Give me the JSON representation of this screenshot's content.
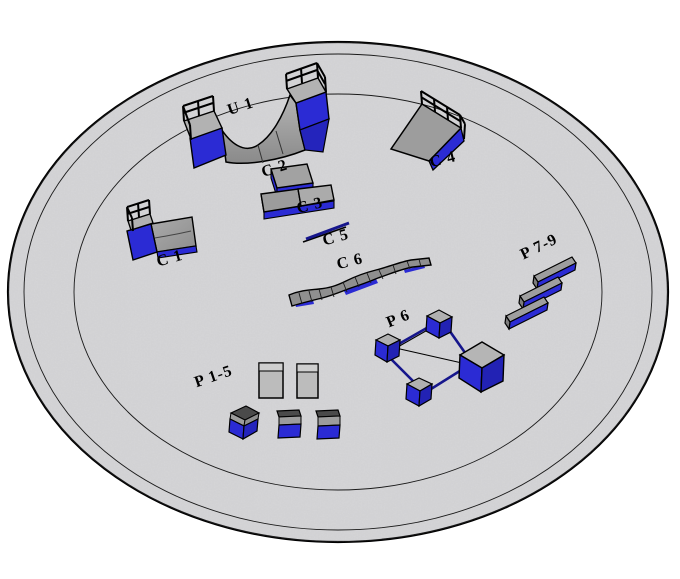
{
  "viewport": {
    "width": 680,
    "height": 579,
    "background": "#ffffff"
  },
  "pad": {
    "surface_color": "#d8d8da",
    "edge_color": "#000000",
    "ring_count": 3
  },
  "palette": {
    "obstacle_blue": "#2b2bd4",
    "obstacle_blue_dark": "#2222b4",
    "rail_navy": "#16168c",
    "ramp_gray": "#9a9a9a",
    "deck_gray": "#b5b5b5",
    "cube_top_dark": "#4a4a4a",
    "outline": "#000000"
  },
  "obstacles": [
    {
      "id": "u1",
      "label": "U 1"
    },
    {
      "id": "c1",
      "label": "C 1"
    },
    {
      "id": "c2",
      "label": "C 2"
    },
    {
      "id": "c3",
      "label": "C 3"
    },
    {
      "id": "c4",
      "label": "C 4"
    },
    {
      "id": "c5",
      "label": "C 5"
    },
    {
      "id": "c6",
      "label": "C 6"
    },
    {
      "id": "p15",
      "label": "P 1-5"
    },
    {
      "id": "p6",
      "label": "P 6"
    },
    {
      "id": "p79",
      "label": "P 7-9"
    }
  ]
}
